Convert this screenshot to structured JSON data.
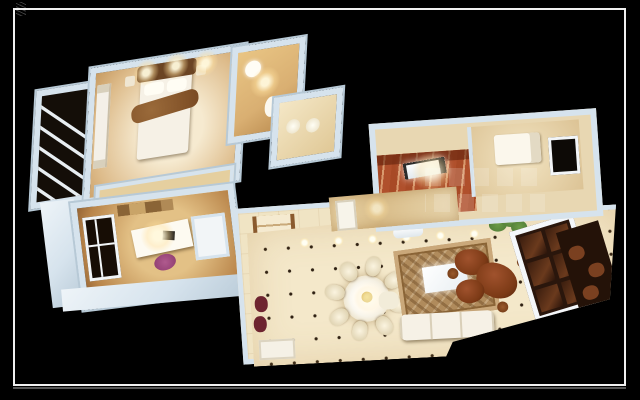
{
  "scene": {
    "kind": "3d-rendered-floorplan",
    "view": "top-down dollhouse cutaway on black background with thin picture frame",
    "rooms": [
      "balcony",
      "master-bedroom",
      "bathroom-gold",
      "bathroom-small",
      "study",
      "stair-hall",
      "dining-area",
      "living-area",
      "kitchen",
      "bedroom-2",
      "corridor",
      "window-nook"
    ],
    "objects": [
      "double-bed",
      "wardrobe",
      "fur-throw",
      "wash-basin",
      "toilet",
      "desk",
      "laptop",
      "purple-chair",
      "bookshelf",
      "spiral-staircase",
      "round-dining-table",
      "dining-chairs",
      "ornate-rug",
      "glass-coffee-table",
      "sofa",
      "armchair",
      "root-wood-tea-table",
      "stools",
      "potted-plant",
      "french-door",
      "air-conditioner",
      "gas-stove",
      "single-bed",
      "dark-window"
    ]
  },
  "palette": {
    "background": "#000000",
    "frame": "#f0f0f0",
    "wall": "#d6e3ed",
    "wall_bright": "#eef4f8",
    "wall_shadow": "#b7c9d6",
    "floor_cream": "#f4e8ca",
    "floor_warm": "#ddbb8a",
    "floor_gold": "#d9af72",
    "wood_dark": "#6b4423",
    "stair_rail": "#8a5a2e",
    "kitchen_red": "#b0502c",
    "rug": "#b08b5c",
    "sofa": "#f6f1e6",
    "plant": "#4e7a37",
    "chair_purple": "#8c3a6e",
    "table_flowers": "#e8c84a"
  },
  "counts": {
    "dining_chairs": 8,
    "balcony_railing_bars": 5,
    "hall_spotlights": 6,
    "bedroom_ceiling_lights": 3,
    "french_door_panes": 6,
    "watermark_rows": 2
  }
}
